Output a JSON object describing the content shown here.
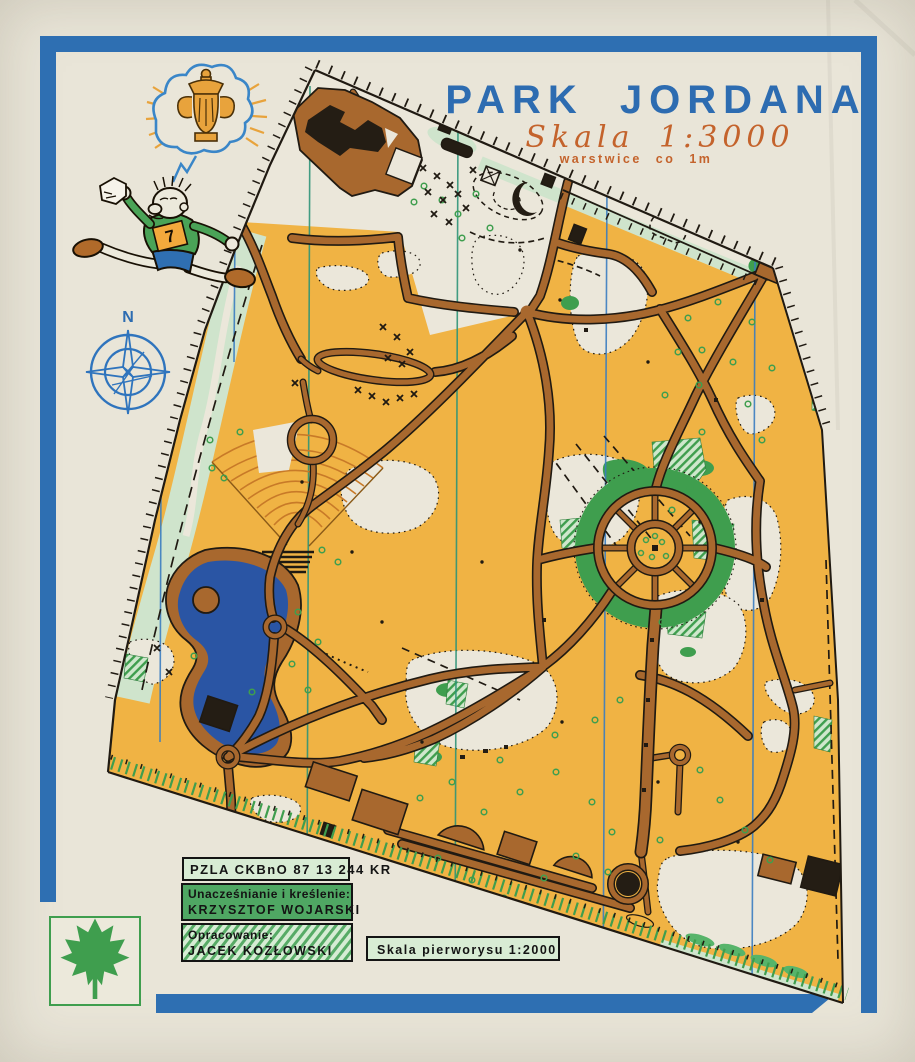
{
  "sheet": {
    "background": "#e9e5d8",
    "frame_color": "#2e6fb2"
  },
  "header": {
    "title": "PARK JORDANA",
    "title_color": "#2d6cb1",
    "subtitle": "Skala 1:3000",
    "note": "warstwice co 1m",
    "accent_color": "#c4632c"
  },
  "compass": {
    "label": "N"
  },
  "mascot": {
    "bib": "7"
  },
  "credits": {
    "code": "PZLA CKBnO 87 13 244 KR",
    "drafting_label": "Unacześnianie i kreślenie:",
    "drafting_name": "KRZYSZTOF WOJARSKI",
    "compilation_label": "Opracowanie:",
    "compilation_name": "JACEK KOZŁOWSKI",
    "source_scale": "Skala pierworysu 1:2000"
  },
  "map": {
    "subject": "Park Jordana",
    "colors": {
      "open_land": "#f0b344",
      "roads": "#a8682e",
      "water": "#2a55a4",
      "vegetation_green": "#3f9e4e",
      "pale_green": "#cfe4cc",
      "north_line_blue": "#3a7cc0",
      "north_line_teal": "#2f9478"
    }
  }
}
